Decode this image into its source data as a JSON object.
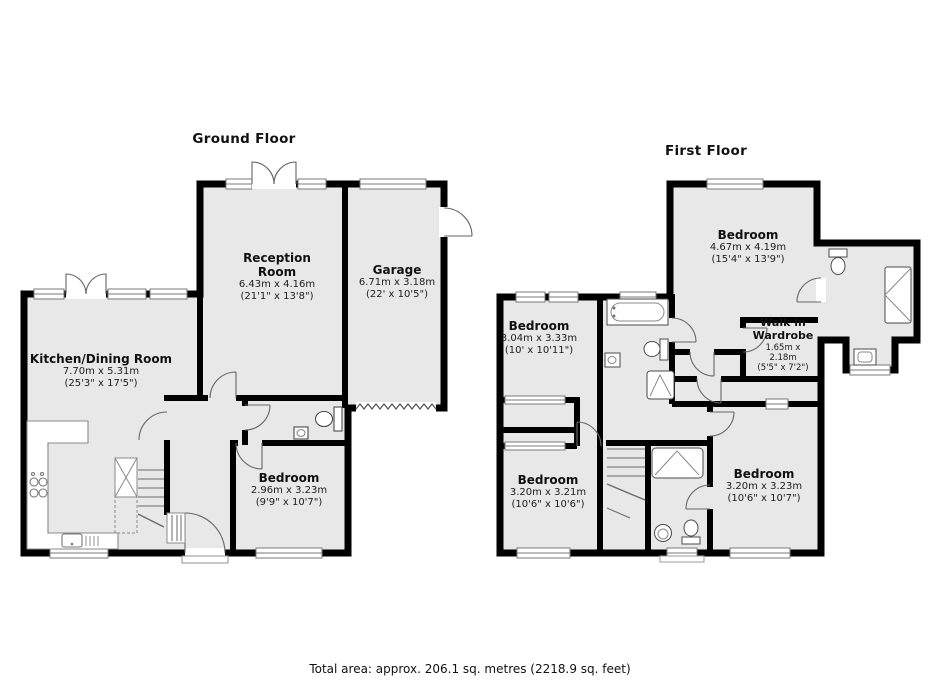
{
  "ground_floor": {
    "title": "Ground Floor",
    "rooms": [
      {
        "name": "Reception Room",
        "dims_m": "6.43m x 4.16m",
        "dims_ft": "(21'1\" x 13'8\")"
      },
      {
        "name": "Garage",
        "dims_m": "6.71m x 3.18m",
        "dims_ft": "(22' x 10'5\")"
      },
      {
        "name": "Kitchen/Dining Room",
        "dims_m": "7.70m x 5.31m",
        "dims_ft": "(25'3\" x 17'5\")"
      },
      {
        "name": "Bedroom",
        "dims_m": "2.96m x 3.23m",
        "dims_ft": "(9'9\" x 10'7\")"
      }
    ]
  },
  "first_floor": {
    "title": "First Floor",
    "rooms": [
      {
        "name": "Bedroom",
        "dims_m": "4.67m x 4.19m",
        "dims_ft": "(15'4\" x 13'9\")"
      },
      {
        "name": "Bedroom",
        "dims_m": "3.04m x 3.33m",
        "dims_ft": "(10' x 10'11\")"
      },
      {
        "name": "Walk in Wardrobe",
        "dims_m": "1.65m x 2.18m",
        "dims_ft": "(5'5\" x 7'2\")"
      },
      {
        "name": "Bedroom",
        "dims_m": "3.20m x 3.21m",
        "dims_ft": "(10'6\" x 10'6\")"
      },
      {
        "name": "Bedroom",
        "dims_m": "3.20m x 3.23m",
        "dims_ft": "(10'6\" x 10'7\")"
      }
    ]
  },
  "footer": {
    "total_area": "Total area: approx. 206.1 sq. metres (2218.9 sq. feet)"
  },
  "colors": {
    "wall": "#000000",
    "room_fill": "#e8e8e8",
    "fixture_line": "#4a4a4a",
    "window_line": "#7a7a7a"
  }
}
